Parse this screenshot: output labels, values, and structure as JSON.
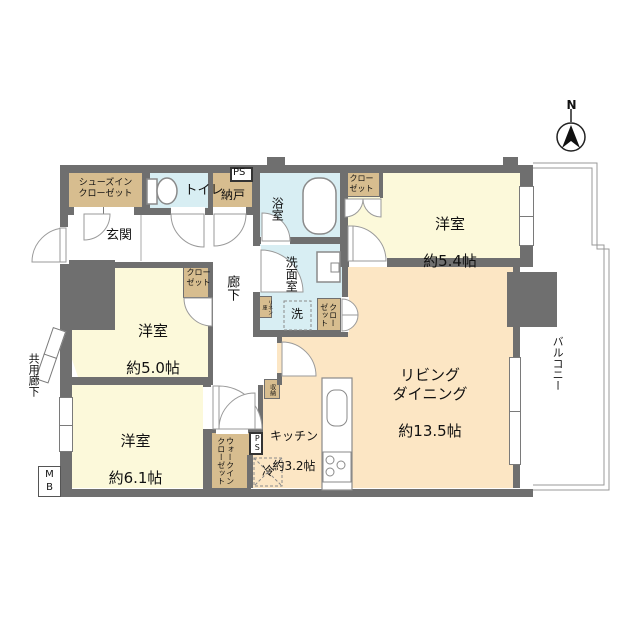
{
  "labels": {
    "compass": "N",
    "shoes_closet": "シューズイン\nクローゼット",
    "toilet": "トイレ",
    "ps": "PS",
    "nando": "納戸",
    "bath": "浴室",
    "closet": "クロー\nゼット",
    "genkan": "玄関",
    "hall": "廊下",
    "washroom": "洗面室",
    "washer": "洗",
    "linen": "リネン庫",
    "shuno": "収納",
    "fridge": "冷",
    "room54_name": "洋室",
    "room54_size": "約5.4帖",
    "room50_name": "洋室",
    "room50_size": "約5.0帖",
    "room61_name": "洋室",
    "room61_size": "約6.1帖",
    "living_name": "リビング\nダイニング",
    "living_size": "約13.5帖",
    "kitchen_name": "キッチン",
    "kitchen_size": "約3.2帖",
    "wic": "ウォークイン\nクローゼット",
    "balcony": "バルコニー",
    "common_corridor": "共用廊下",
    "mb": "M\nB"
  },
  "colors": {
    "wall": "#6f6f6f",
    "closet_tan": "#d7bd8f",
    "room_yellow": "#fcf9da",
    "living_peach": "#fce6c4",
    "wet_blue": "#d8eef3",
    "outline_thin": "#999999",
    "fixture_stroke": "#8a8a8a"
  }
}
